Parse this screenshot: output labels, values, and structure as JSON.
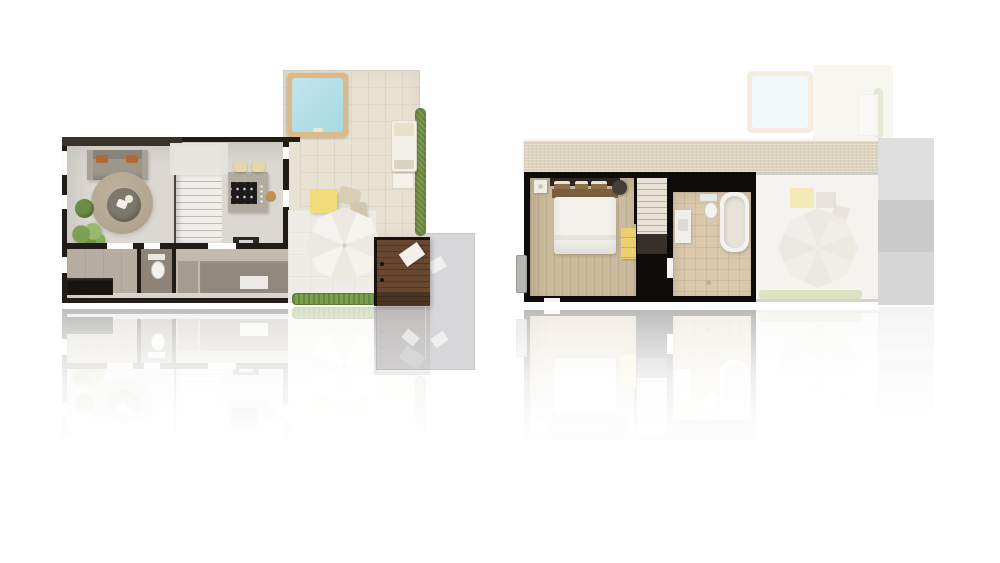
{
  "canvas": {
    "width": 1000,
    "height": 563,
    "background": "#ffffff"
  },
  "palette": {
    "background": "#ffffff",
    "wall_dark": "#211c16",
    "wall_brown": "#3a3128",
    "floor_gray": "#dbd8d2",
    "hall_gray": "#e4e2dc",
    "tile_gray": "#b5ada0",
    "wc_floor": "#8f8378",
    "store_floor": "#c3bbae",
    "counter_gray": "#8f887c",
    "terrace_beige": "#e9e2d3",
    "patio_white": "#eeece6",
    "pool_frame": "#dcb988",
    "pool_water": "#a7d9e2",
    "hedge_green": "#7f9b53",
    "grass_green": "#7ba04b",
    "pouf_green": "#6c8d45",
    "rug_tan": "#b3a791",
    "table_round_gray": "#7e776b",
    "sofa_gray": "#9d968a",
    "pillow_orange": "#b16a35",
    "stool_tan": "#e7d6ab",
    "island_gray": "#b2aba0",
    "cooktop_black": "#1d1c1a",
    "umbrella_white": "#f3f1ea",
    "table_yellow": "#f0dc79",
    "deck_brown": "#67472f",
    "deck_dark": "#4a3422",
    "doormat_white": "#f2f0ea",
    "driveway_gray": "#b0b0b3",
    "roof_tan": "#ddd3bd",
    "bedroom_wood": "#ccba9c",
    "bed_white": "#f3f1ec",
    "pillow_brown": "#8d6f47",
    "headboard_dark": "#2c2620",
    "bedframe_wood": "#7a5f3e",
    "dresser_yellow": "#ecd06f",
    "stairs_white": "#f0eeea",
    "stairs_dark": "#363029",
    "bath_tile": "#d9c8ac",
    "fixture_white": "#f4f2ee",
    "ghost_floor": "#f4f3f0",
    "gray_column": "#d4d4d4",
    "chair_cream": "#d9cdb4",
    "plant_green": "#7da053"
  },
  "scene": {
    "left_plan": {
      "name": "ground-floor-plan",
      "areas": [
        "terrace",
        "plunge-pool",
        "sun-lounger",
        "hedge",
        "living-room",
        "sofa",
        "round-rug",
        "coffee-table",
        "pouf",
        "plant",
        "staircase",
        "kitchen-island",
        "bar-stools",
        "utility-room",
        "wc",
        "storage",
        "patio",
        "parasol",
        "outdoor-table",
        "grass-strip",
        "entrance-deck",
        "doormat",
        "driveway"
      ]
    },
    "right_plan": {
      "name": "upper-floor-plan",
      "areas": [
        "roof-strip",
        "bedroom",
        "double-bed",
        "nightstand",
        "armchair",
        "dresser",
        "staircase",
        "bathroom",
        "toilet",
        "bathtub",
        "vanity",
        "void-over-patio-ghost",
        "terrace-pool-ghost",
        "gray-side-volume"
      ]
    },
    "reflection": {
      "present": true,
      "opacity": 0.32
    }
  }
}
